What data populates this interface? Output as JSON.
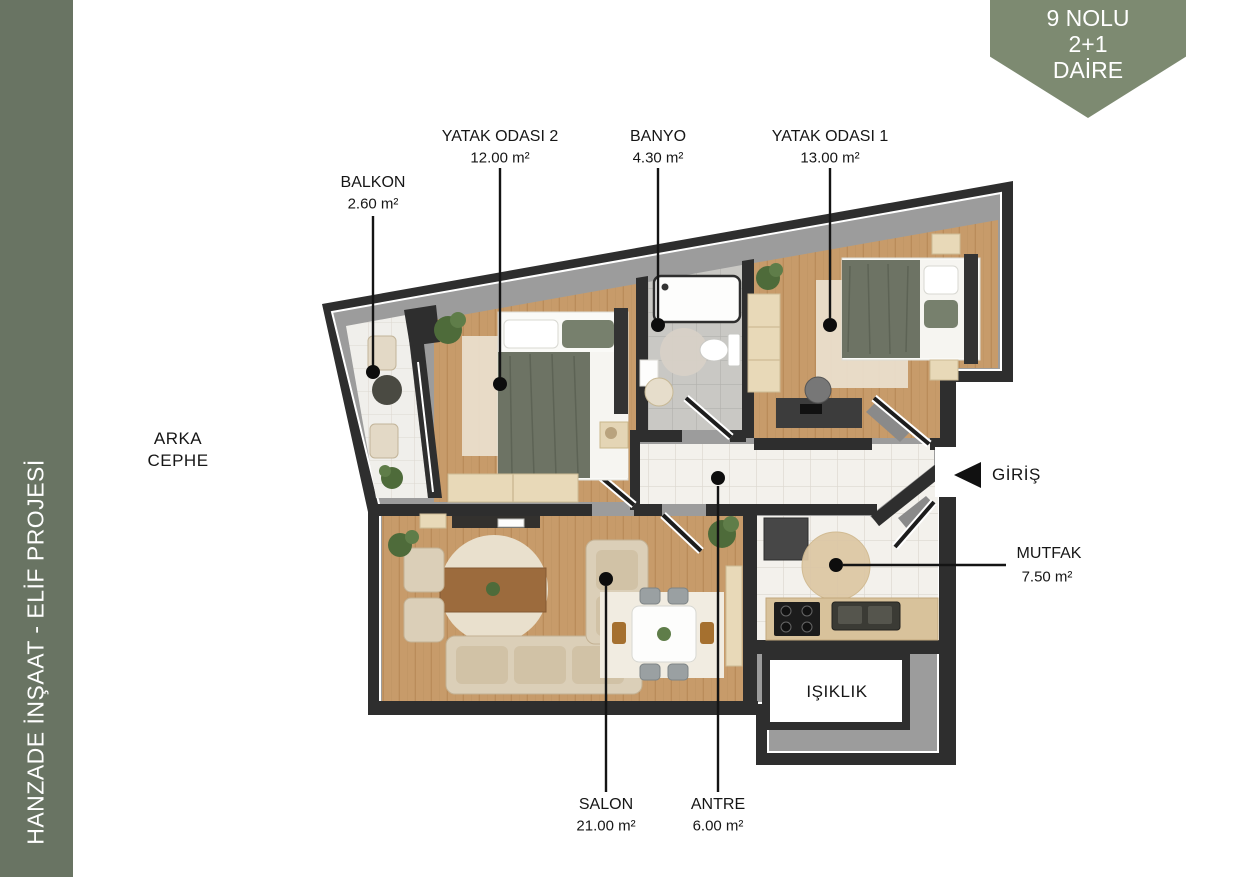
{
  "sidebar": {
    "title": "HANZADE İNŞAAT - ELİF PROJESİ",
    "bg": "#697463",
    "text_color": "#ffffff"
  },
  "badge": {
    "line1": "9 NOLU",
    "line2": "2+1",
    "line3": "DAİRE",
    "bg": "#7d8a71",
    "text_color": "#ffffff"
  },
  "plan": {
    "facade_line1": "ARKA",
    "facade_line2": "CEPHE",
    "entrance_label": "GİRİŞ",
    "rooms": [
      {
        "name": "BALKON",
        "area": "2.60 m²"
      },
      {
        "name": "YATAK ODASI 2",
        "area": "12.00 m²"
      },
      {
        "name": "BANYO",
        "area": "4.30 m²"
      },
      {
        "name": "YATAK ODASI 1",
        "area": "13.00 m²"
      },
      {
        "name": "SALON",
        "area": "21.00 m²"
      },
      {
        "name": "ANTRE",
        "area": "6.00 m²"
      },
      {
        "name": "MUTFAK",
        "area": "7.50 m²"
      },
      {
        "name": "IŞIKLIK",
        "area": ""
      }
    ],
    "colors": {
      "wall": "#2e2e2e",
      "wall_inner": "#9c9c9c",
      "wood_floor": "#c79b6a",
      "tile_white": "#f3f1ec",
      "tile_gray": "#c9c8c4",
      "accent_sage": "#6d7364",
      "leader": "#141414"
    }
  }
}
